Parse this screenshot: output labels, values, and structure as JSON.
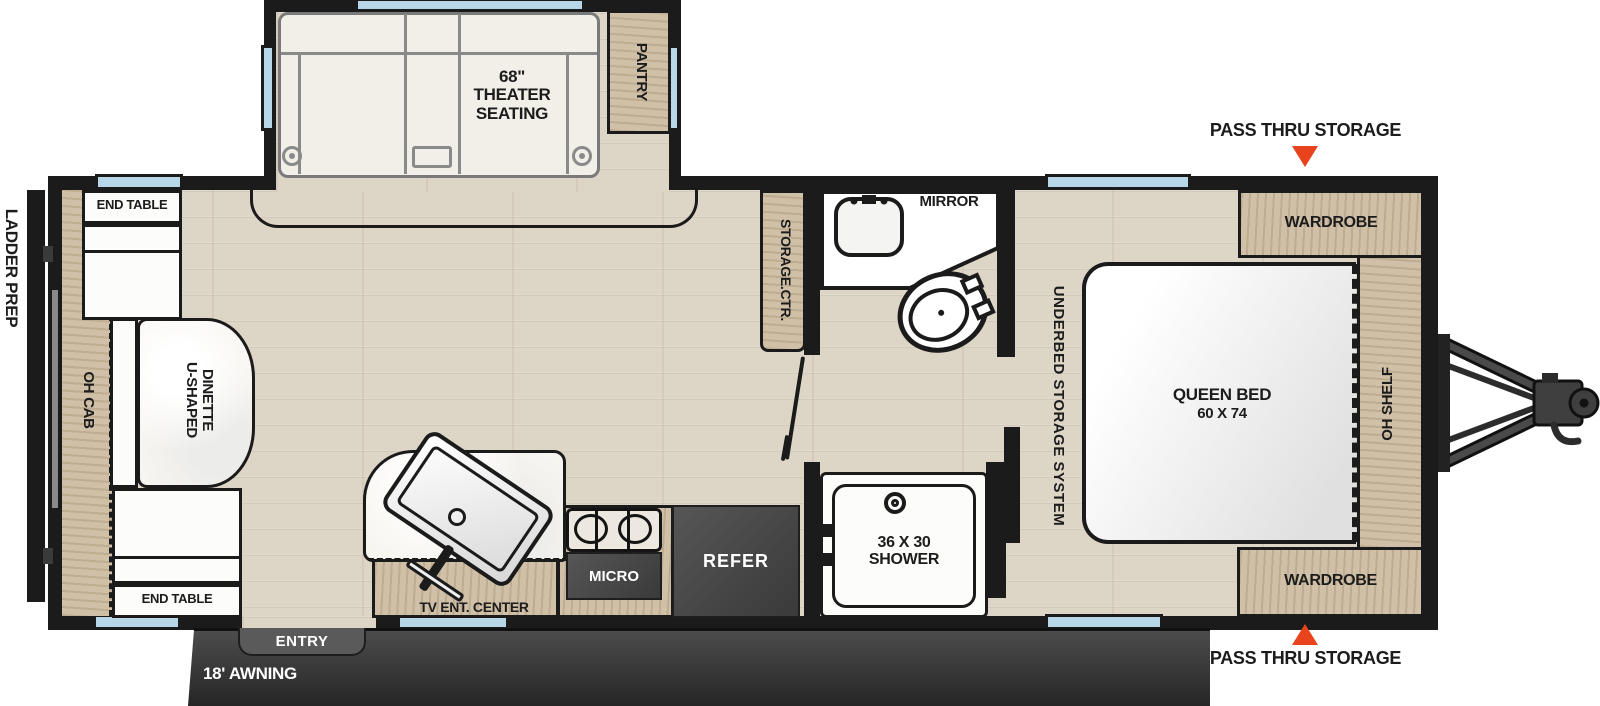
{
  "labels": {
    "ladder_prep": "LADDER PREP",
    "oh_cab": "OH CAB",
    "end_table_top": "END TABLE",
    "end_table_bottom": "END TABLE",
    "dinette_col_left": "U-SHAPED",
    "dinette_col_right": "DINETTE",
    "theater_line1": "68\"",
    "theater_line2": "THEATER",
    "theater_line3": "SEATING",
    "pantry": "PANTRY",
    "storage_ctr": "STORAGE.CTR.",
    "mirror": "MIRROR",
    "underbed": "UNDERBED STORAGE SYSTEM",
    "queen_bed_line1": "QUEEN BED",
    "queen_bed_line2": "60 X 74",
    "wardrobe_top": "WARDROBE",
    "wardrobe_bottom": "WARDROBE",
    "oh_shelf": "OH SHELF",
    "pass_thru_top": "PASS THRU STORAGE",
    "pass_thru_bottom": "PASS THRU STORAGE",
    "tv_ent_center": "TV ENT. CENTER",
    "micro": "MICRO",
    "refer": "REFER",
    "shower_line1": "36 X 30",
    "shower_line2": "SHOWER",
    "entry": "ENTRY",
    "awning": "18' AWNING"
  },
  "colors": {
    "accent_orange": "#e8431c",
    "wall_black": "#1b1b1b",
    "wood_tan": "#cfc0a7",
    "window_blue": "#b7d7e9",
    "appliance_gray": "#464646",
    "floor_beige": "#ddd5c6"
  }
}
